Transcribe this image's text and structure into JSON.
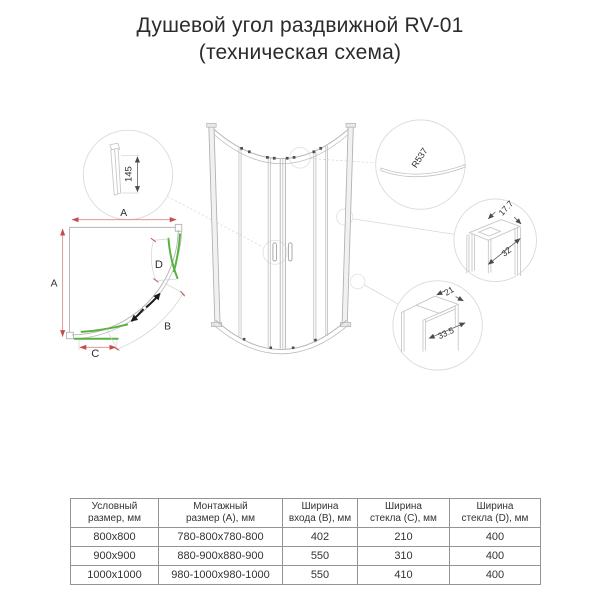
{
  "title": {
    "line1": "Душевой угол раздвижной RV-01",
    "line2": "(техническая схема)"
  },
  "diagram": {
    "plan": {
      "dim_a_top": "A",
      "dim_a_left": "A",
      "dim_b": "B",
      "dim_c": "C",
      "dim_d": "D"
    },
    "details": {
      "wall_profile_height": "145",
      "radius": "R537",
      "roller_profile": {
        "width": "17.7",
        "depth": "32"
      },
      "wall_profile": {
        "width": "21",
        "depth": "33.5"
      }
    }
  },
  "table": {
    "headers": [
      "Условный\nразмер, мм",
      "Монтажный\nразмер (А), мм",
      "Ширина\nвхода (В), мм",
      "Ширина\nстекла (С), мм",
      "Ширина\nстекла (D), мм"
    ],
    "rows": [
      [
        "800х800",
        "780-800х780-800",
        "402",
        "210",
        "400"
      ],
      [
        "900х900",
        "880-900х880-900",
        "550",
        "310",
        "400"
      ],
      [
        "1000х1000",
        "980-1000х980-1000",
        "550",
        "410",
        "400"
      ]
    ]
  },
  "colors": {
    "line_gray": "#b5b5b5",
    "dim_red": "#c0504d",
    "glass_green": "#57b33e",
    "text": "#2e2e2e"
  }
}
